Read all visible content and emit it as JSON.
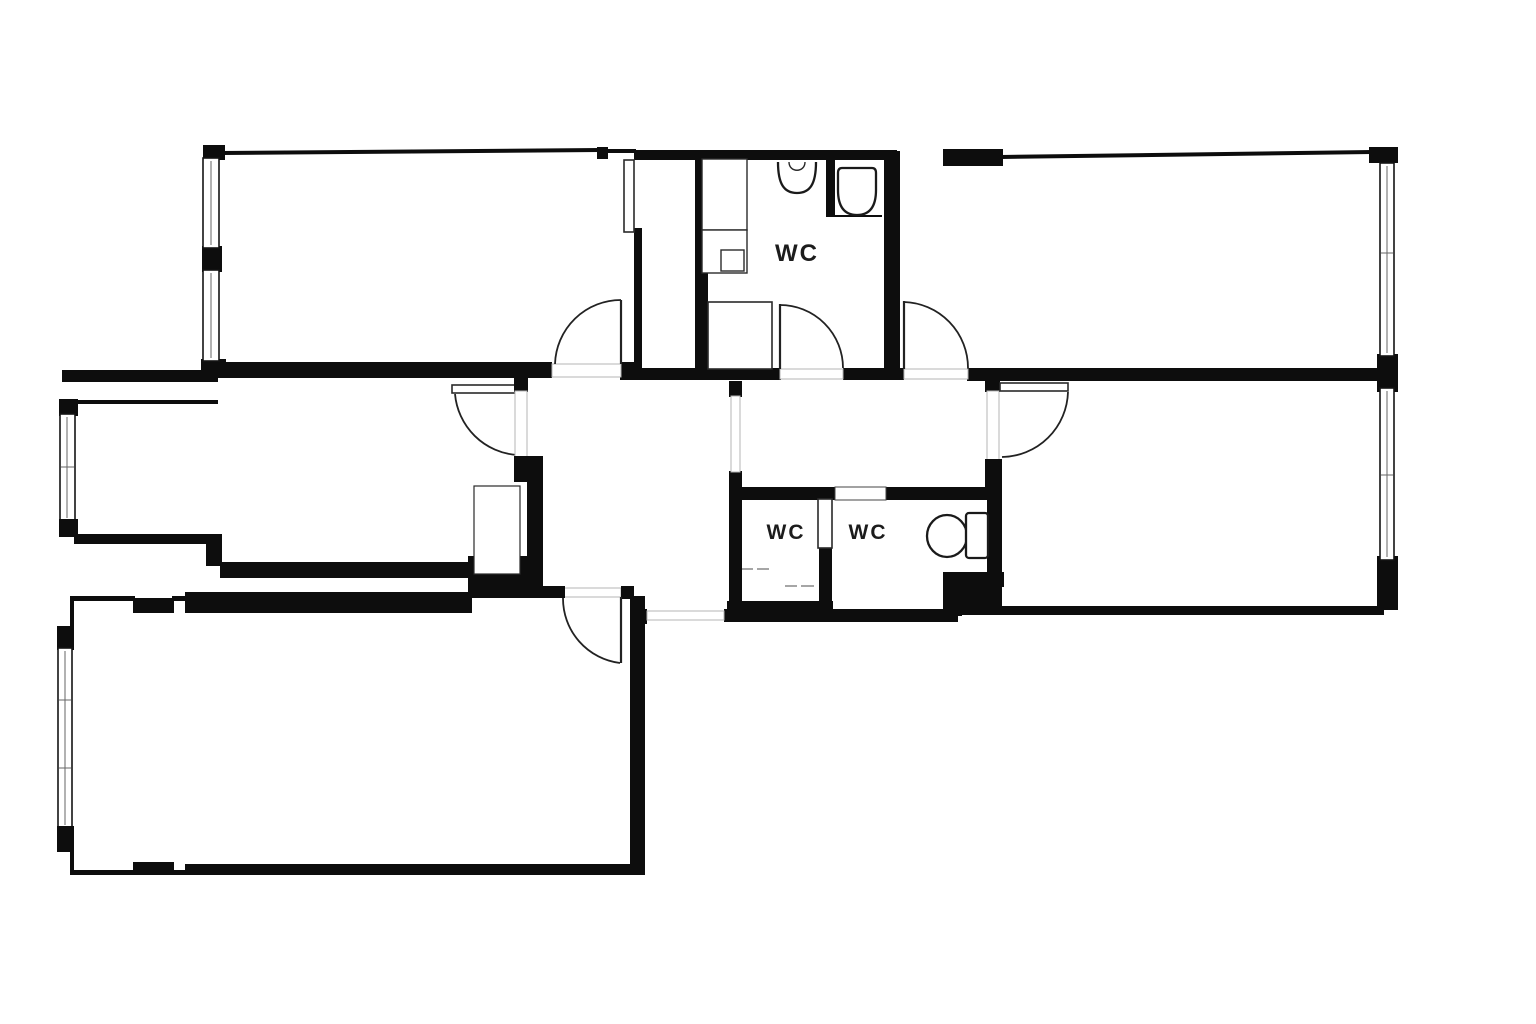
{
  "document": {
    "type": "architectural-floor-plan",
    "style": "black-and-white line drawing, thick black interior walls, thin exterior walls, door swing arcs, window frames"
  },
  "labels": {
    "wc_main": "WC",
    "wc_small_left": "WC",
    "wc_small_right": "WC"
  },
  "colors": {
    "background": "#ffffff",
    "walls": "#0d0d0d",
    "threshold_line": "#b5b5b5",
    "fixture_stroke": "#1a1a1a",
    "label_text": "#1c1c1c"
  },
  "fixtures": [
    "sink-icon",
    "toilet-icon-main-wc",
    "toilet-icon-small-wc",
    "shower-tray-icon",
    "cabinet-icon",
    "wardrobe-icon"
  ],
  "doors_with_swing_arcs": 6,
  "window_count": 6
}
